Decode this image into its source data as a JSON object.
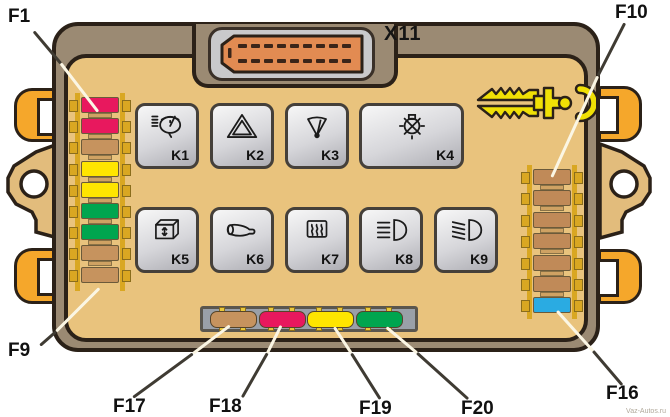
{
  "connector": {
    "label": "X11"
  },
  "labels": {
    "f1": "F1",
    "f9": "F9",
    "f10": "F10",
    "f16": "F16",
    "f17": "F17",
    "f18": "F18",
    "f19": "F19",
    "f20": "F20"
  },
  "relays": [
    {
      "id": "K1",
      "label": "K1",
      "icon": "headlight-washer-relay-icon"
    },
    {
      "id": "K2",
      "label": "K2",
      "icon": "hazard-warning-relay-icon"
    },
    {
      "id": "K3",
      "label": "K3",
      "icon": "windshield-wiper-relay-icon"
    },
    {
      "id": "K4",
      "label": "K4",
      "icon": "lamp-check-relay-icon"
    },
    {
      "id": "K5",
      "label": "K5",
      "icon": "power-window-relay-icon"
    },
    {
      "id": "K6",
      "label": "K6",
      "icon": "horn-relay-icon"
    },
    {
      "id": "K7",
      "label": "K7",
      "icon": "rear-defogger-relay-icon"
    },
    {
      "id": "K8",
      "label": "K8",
      "icon": "high-beam-relay-icon"
    },
    {
      "id": "K9",
      "label": "K9",
      "icon": "low-beam-relay-icon"
    }
  ],
  "fuse_columns": {
    "left": [
      {
        "id": "F1",
        "color": "crimson"
      },
      {
        "id": "F2",
        "color": "crimson"
      },
      {
        "id": "F3",
        "color": "tan"
      },
      {
        "id": "F4",
        "color": "yellow"
      },
      {
        "id": "F5",
        "color": "yellow"
      },
      {
        "id": "F6",
        "color": "green"
      },
      {
        "id": "F7",
        "color": "green"
      },
      {
        "id": "F8",
        "color": "tan"
      },
      {
        "id": "F9",
        "color": "tan"
      }
    ],
    "right": [
      {
        "id": "F10",
        "color": "brown"
      },
      {
        "id": "F11",
        "color": "brown"
      },
      {
        "id": "F12",
        "color": "brown"
      },
      {
        "id": "F13",
        "color": "brown"
      },
      {
        "id": "F14",
        "color": "brown"
      },
      {
        "id": "F15",
        "color": "brown"
      },
      {
        "id": "F16",
        "color": "blue"
      }
    ]
  },
  "bottom_fuses": [
    {
      "id": "F17",
      "color": "tan"
    },
    {
      "id": "F18",
      "color": "crimson"
    },
    {
      "id": "F19",
      "color": "yellow"
    },
    {
      "id": "F20",
      "color": "green"
    }
  ],
  "palette": {
    "crimson": "#e8185e",
    "tan": "#c6935e",
    "brown": "#c08a58",
    "yellow": "#ffe500",
    "green": "#00a54f",
    "blue": "#2aabe2",
    "gold": "#d9a722",
    "panel": "#e9c37d",
    "case": "#9b8a73",
    "outline": "#2b2118",
    "orange_clip": "#f5a72b",
    "connector_orange": "#e28b52",
    "shell_gray": "#c9c9cb",
    "relay_face": "#d8d8da",
    "tray_gray": "#9aa0a8",
    "tool_yellow": "#f0e005"
  },
  "tool": {
    "name": "fuse-puller"
  },
  "watermark": "Vaz-Autos.ru"
}
